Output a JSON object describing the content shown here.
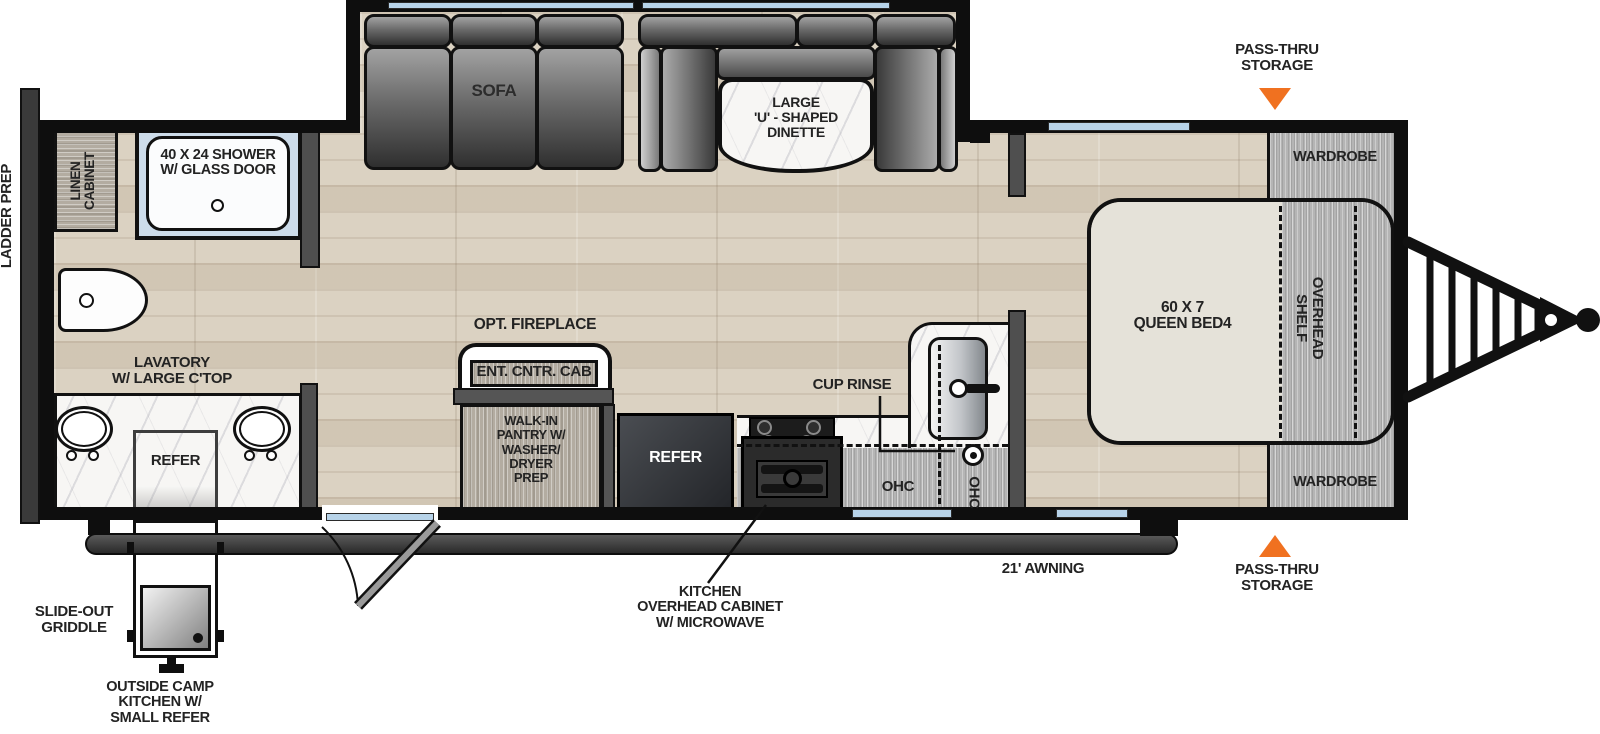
{
  "title": "travel trailer floor plan",
  "colors": {
    "accent_orange": "#f07120",
    "window_blue": "#b7d3e9",
    "wall_black": "#0e0e0e",
    "floor_tan": "#dbd2c2",
    "mattress_beige": "#e5e2d9",
    "cabinet_gray": "#b5b5b5"
  },
  "exterior": {
    "ladder_prep": "LADDER PREP",
    "pass_thru_top": "PASS-THRU\nSTORAGE",
    "pass_thru_bottom": "PASS-THRU\nSTORAGE",
    "awning": "21' AWNING",
    "slide_out_griddle": "SLIDE-OUT\nGRIDDLE",
    "outside_camp_kitchen": "OUTSIDE CAMP\nKITCHEN W/\nSMALL REFER"
  },
  "bathroom": {
    "linen_cabinet": "LINEN\nCABINET",
    "shower": "40 X 24 SHOWER\nW/ GLASS DOOR",
    "lavatory": "LAVATORY\nW/ LARGE C'TOP",
    "refer": "REFER"
  },
  "living": {
    "sofa": "SOFA",
    "dinette": "LARGE\n'U' - SHAPED\nDINETTE",
    "opt_fireplace": "OPT. FIREPLACE",
    "ent_cntr_cab": "ENT. CNTR. CAB",
    "pantry": "WALK-IN\nPANTRY W/\nWASHER/\nDRYER\nPREP"
  },
  "kitchen": {
    "refer": "REFER",
    "cup_rinse": "CUP RINSE",
    "ohc_left": "OHC",
    "ohc_right": "OHC",
    "overhead_cabinet": "KITCHEN\nOVERHEAD CABINET\nW/ MICROWAVE"
  },
  "bedroom": {
    "wardrobe_top": "WARDROBE",
    "wardrobe_bottom": "WARDROBE",
    "bed": "60 X 7\nQUEEN BED4",
    "overhead_shelf": "OVERHEAD\nSHELF"
  }
}
